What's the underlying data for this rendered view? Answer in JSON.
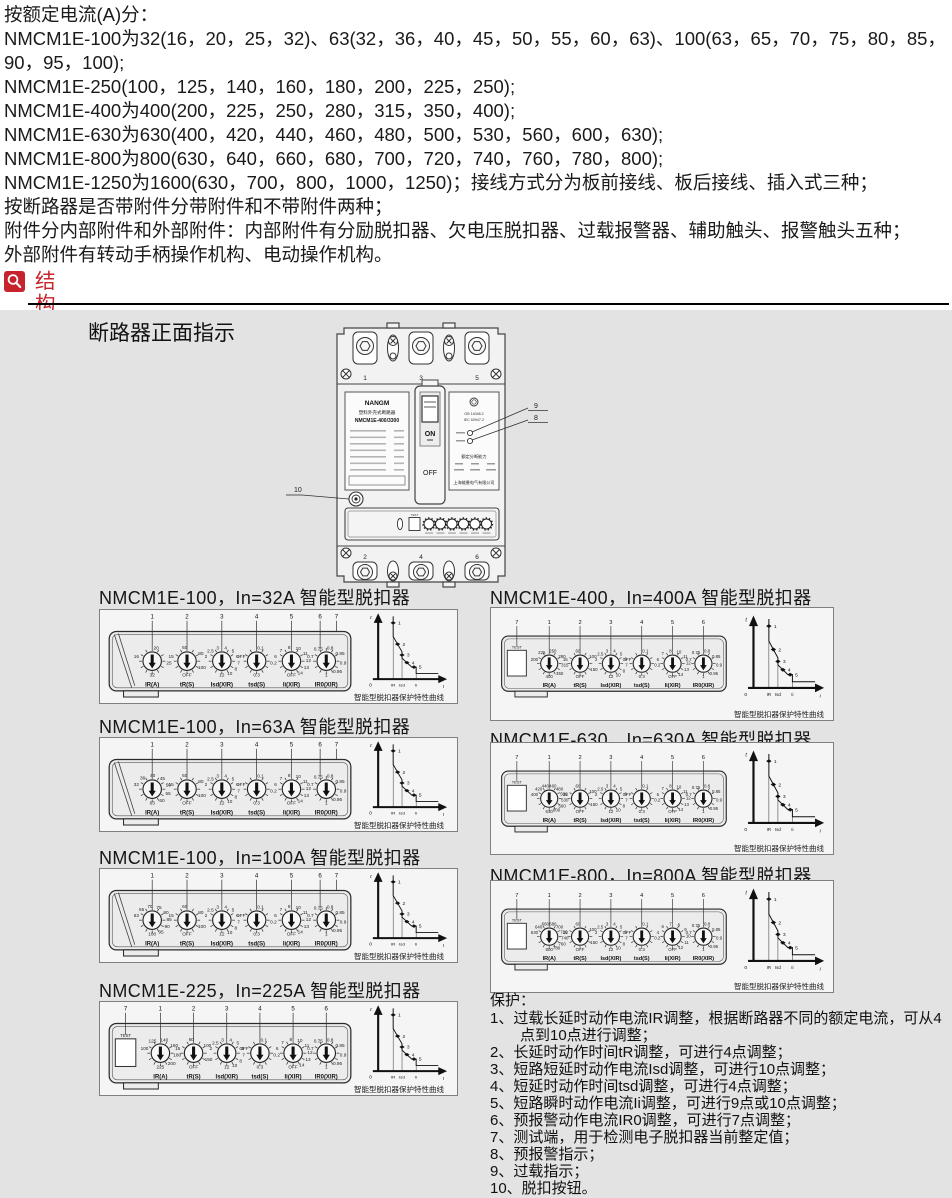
{
  "intro": {
    "lines": [
      "按额定电流(A)分：",
      "NMCM1E-100为32(16，20，25，32)、63(32，36，40，45，50，55，60，63)、100(63，65，70，75，80，85，",
      "90，95，100);",
      "NMCM1E-250(100，125，140，160，180，200，225，250);",
      "NMCM1E-400为400(200，225，250，280，315，350，400);",
      "NMCM1E-630为630(400，420，440，460，480，500，530，560，600，630);",
      "NMCM1E-800为800(630，640，660，680，700，720，740，760，780，800);",
      "NMCM1E-1250为1600(630，700，800，1000，1250)；接线方式分为板前接线、板后接线、插入式三种；",
      "按断路器是否带附件分带附件和不带附件两种；",
      "附件分内部附件和外部附件：内部附件有分励脱扣器、欠电压脱扣器、过载报警器、辅助触头、报警触头五种；",
      "外部附件有转动手柄操作机构、电动操作机构。"
    ]
  },
  "header": {
    "label": "结构简介"
  },
  "panel": {
    "front_title": "断路器正面指示",
    "breaker": {
      "brand": "NANGM",
      "product": "塑料外壳式断路器",
      "model": "NMCM1E-400/3300",
      "on": "ON",
      "off": "OFF",
      "test": "TEST",
      "top_terminals": [
        "1",
        "3",
        "5"
      ],
      "bottom_terminals": [
        "2",
        "4",
        "6"
      ],
      "standards": [
        "GB 14048.2",
        "IEC 60947-2"
      ],
      "breaking_label": "额定分断能力",
      "company": "上海能曼电气有限公司",
      "callouts": {
        "pre_alarm": "8",
        "overload": "9",
        "trip_button": "10"
      }
    },
    "units": [
      {
        "title": "NMCM1E-100，In=32A 智能型脱扣器",
        "test": false,
        "callouts": [
          "1",
          "2",
          "3",
          "4",
          "5",
          "6",
          "7"
        ],
        "dials": [
          {
            "label": "IR(A)",
            "values": [
              "16",
              "20",
              "25",
              "32"
            ]
          },
          {
            "label": "tR(S)",
            "values": [
              "15",
              "60",
              "80",
              "100",
              "OFF"
            ]
          },
          {
            "label": "Isd(XIR)",
            "values": [
              "2",
              "2.5",
              "3",
              "4",
              "5",
              "6",
              "7",
              "8",
              "10",
              "12"
            ]
          },
          {
            "label": "tsd(S)",
            "values": [
              "OFF",
              "0.1",
              "0.2",
              "0.3"
            ]
          },
          {
            "label": "Ii(XIR)",
            "values": [
              "6",
              "7",
              "8",
              "10",
              "11",
              "12",
              "13",
              "14",
              "OFF"
            ]
          },
          {
            "label": "IR0(XIR)",
            "values": [
              "0.7",
              "0.75",
              "0.8",
              "0.85",
              "0.9",
              "0.95",
              "1"
            ]
          }
        ]
      },
      {
        "title": "NMCM1E-100，In=63A 智能型脱扣器",
        "test": false,
        "callouts": [
          "1",
          "2",
          "3",
          "4",
          "5",
          "6",
          "7"
        ],
        "dials": [
          {
            "label": "IR(A)",
            "values": [
              "32",
              "36",
              "40",
              "45",
              "50",
              "55",
              "60",
              "63"
            ]
          },
          {
            "label": "tR(S)",
            "values": [
              "15",
              "60",
              "80",
              "100",
              "OFF"
            ]
          },
          {
            "label": "Isd(XIR)",
            "values": [
              "2",
              "2.5",
              "3",
              "4",
              "5",
              "6",
              "7",
              "8",
              "10",
              "12"
            ]
          },
          {
            "label": "tsd(S)",
            "values": [
              "OFF",
              "0.1",
              "0.2",
              "0.3"
            ]
          },
          {
            "label": "Ii(XIR)",
            "values": [
              "6",
              "7",
              "8",
              "10",
              "11",
              "12",
              "13",
              "14",
              "OFF"
            ]
          },
          {
            "label": "IR0(XIR)",
            "values": [
              "0.7",
              "0.75",
              "0.8",
              "0.85",
              "0.9",
              "0.95",
              "1"
            ]
          }
        ]
      },
      {
        "title": "NMCM1E-100，In=100A 智能型脱扣器",
        "test": false,
        "callouts": [
          "1",
          "2",
          "3",
          "4",
          "5",
          "6",
          "7"
        ],
        "dials": [
          {
            "label": "IR(A)",
            "values": [
              "63",
              "65",
              "70",
              "75",
              "80",
              "85",
              "90",
              "95",
              "100"
            ]
          },
          {
            "label": "tR(S)",
            "values": [
              "15",
              "60",
              "80",
              "100",
              "OFF"
            ]
          },
          {
            "label": "Isd(XIR)",
            "values": [
              "2",
              "2.5",
              "3",
              "4",
              "5",
              "6",
              "7",
              "8",
              "10",
              "12"
            ]
          },
          {
            "label": "tsd(S)",
            "values": [
              "OFF",
              "0.1",
              "0.2",
              "0.3"
            ]
          },
          {
            "label": "Ii(XIR)",
            "values": [
              "6",
              "7",
              "8",
              "10",
              "11",
              "12",
              "13",
              "14",
              "OFF"
            ]
          },
          {
            "label": "IR0(XIR)",
            "values": [
              "0.7",
              "0.75",
              "0.8",
              "0.85",
              "0.9",
              "0.95",
              "1"
            ]
          }
        ]
      },
      {
        "title": "NMCM1E-225，In=225A 智能型脱扣器",
        "test": true,
        "callouts": [
          "7",
          "1",
          "2",
          "3",
          "4",
          "5",
          "6"
        ],
        "dials": [
          {
            "label": "IR(A)",
            "values": [
              "100",
              "125",
              "140",
              "160",
              "180",
              "200",
              "225"
            ]
          },
          {
            "label": "tR(S)",
            "values": [
              "15",
              "60",
              "100",
              "150",
              "OFF"
            ]
          },
          {
            "label": "Isd(XIR)",
            "values": [
              "2",
              "2.5",
              "3",
              "4",
              "5",
              "6",
              "7",
              "8",
              "10",
              "12"
            ]
          },
          {
            "label": "tsd(S)",
            "values": [
              "OFF",
              "0.1",
              "0.2",
              "0.3"
            ]
          },
          {
            "label": "Ii(XIR)",
            "values": [
              "6",
              "7",
              "8",
              "10",
              "11",
              "12",
              "13",
              "14",
              "OFF"
            ]
          },
          {
            "label": "IR0(XIR)",
            "values": [
              "0.7",
              "0.75",
              "0.8",
              "0.85",
              "0.9",
              "0.95",
              "1"
            ]
          }
        ]
      },
      {
        "title": "NMCM1E-400，In=400A 智能型脱扣器",
        "test": true,
        "callouts": [
          "7",
          "1",
          "2",
          "3",
          "4",
          "5",
          "6"
        ],
        "dials": [
          {
            "label": "IR(A)",
            "values": [
              "200",
              "225",
              "250",
              "280",
              "315",
              "350",
              "400"
            ]
          },
          {
            "label": "tR(S)",
            "values": [
              "15",
              "60",
              "100",
              "150",
              "OFF"
            ]
          },
          {
            "label": "Isd(XIR)",
            "values": [
              "2",
              "2.5",
              "3",
              "4",
              "5",
              "6",
              "7",
              "8",
              "10",
              "12"
            ]
          },
          {
            "label": "tsd(S)",
            "values": [
              "OFF",
              "0.1",
              "0.2",
              "0.3"
            ]
          },
          {
            "label": "Ii(XIR)",
            "values": [
              "6",
              "7",
              "8",
              "10",
              "11",
              "12",
              "13",
              "14",
              "OFF"
            ]
          },
          {
            "label": "IR0(XIR)",
            "values": [
              "0.7",
              "0.75",
              "0.8",
              "0.85",
              "0.9",
              "0.95",
              "1"
            ]
          }
        ]
      },
      {
        "title": "NMCM1E-630，In=630A 智能型脱扣器",
        "test": true,
        "callouts": [
          "7",
          "1",
          "2",
          "3",
          "4",
          "5",
          "6"
        ],
        "dials": [
          {
            "label": "IR(A)",
            "values": [
              "400",
              "420",
              "440",
              "460",
              "480",
              "500",
              "530",
              "560",
              "600",
              "630"
            ]
          },
          {
            "label": "tR(S)",
            "values": [
              "15",
              "60",
              "100",
              "150",
              "OFF"
            ]
          },
          {
            "label": "Isd(XIR)",
            "values": [
              "2",
              "2.5",
              "3",
              "4",
              "5",
              "6",
              "7",
              "8",
              "10",
              "12"
            ]
          },
          {
            "label": "tsd(S)",
            "values": [
              "OFF",
              "0.1",
              "0.2",
              "0.3"
            ]
          },
          {
            "label": "Ii(XIR)",
            "values": [
              "6",
              "7",
              "8",
              "10",
              "11",
              "12",
              "13",
              "14",
              "OFF"
            ]
          },
          {
            "label": "IR0(XIR)",
            "values": [
              "0.7",
              "0.75",
              "0.8",
              "0.85",
              "0.9",
              "0.95",
              "1"
            ]
          }
        ]
      },
      {
        "title": "NMCM1E-800，In=800A 智能型脱扣器",
        "test": true,
        "callouts": [
          "7",
          "1",
          "2",
          "3",
          "4",
          "5",
          "6"
        ],
        "dials": [
          {
            "label": "IR(A)",
            "values": [
              "630",
              "640",
              "660",
              "680",
              "700",
              "720",
              "740",
              "760",
              "780",
              "800"
            ]
          },
          {
            "label": "tR(S)",
            "values": [
              "15",
              "60",
              "100",
              "150",
              "OFF"
            ]
          },
          {
            "label": "Isd(XIR)",
            "values": [
              "2",
              "2.5",
              "3",
              "4",
              "5",
              "6",
              "7",
              "8",
              "10",
              "12"
            ]
          },
          {
            "label": "tsd(S)",
            "values": [
              "OFF",
              "0.1",
              "0.2",
              "0.3"
            ]
          },
          {
            "label": "Ii(XIR)",
            "values": [
              "4",
              "6",
              "7",
              "8",
              "9",
              "10",
              "11",
              "12",
              "OFF"
            ]
          },
          {
            "label": "IR0(XIR)",
            "values": [
              "0.7",
              "0.75",
              "0.8",
              "0.85",
              "0.9",
              "0.95",
              "1"
            ]
          }
        ]
      }
    ],
    "curve": {
      "ylabel": "t",
      "origin": "0",
      "xticks": [
        "IR",
        "Isd",
        "Ii"
      ],
      "xlabel": "I",
      "points": [
        "1",
        "2",
        "3",
        "4",
        "5"
      ],
      "caption": "智能型脱扣器保护特性曲线"
    },
    "protection": {
      "title": "保护：",
      "items": [
        "1、过载长延时动作电流IR调整，根据断路器不同的额定电流，可从4点到10点进行调整；",
        "2、长延时动作时间tR调整，可进行4点调整；",
        "3、短路短延时动作电流Isd调整，可进行10点调整；",
        "4、短延时动作时间tsd调整，可进行4点调整；",
        "5、短路瞬时动作电流Ii调整，可进行9点或10点调整；",
        "6、预报警动作电流IR0调整，可进行7点调整；",
        "7、测试端，用于检测电子脱扣器当前整定值；",
        "8、预报警指示；",
        "9、过载指示；",
        "10、脱扣按钮。"
      ]
    }
  }
}
